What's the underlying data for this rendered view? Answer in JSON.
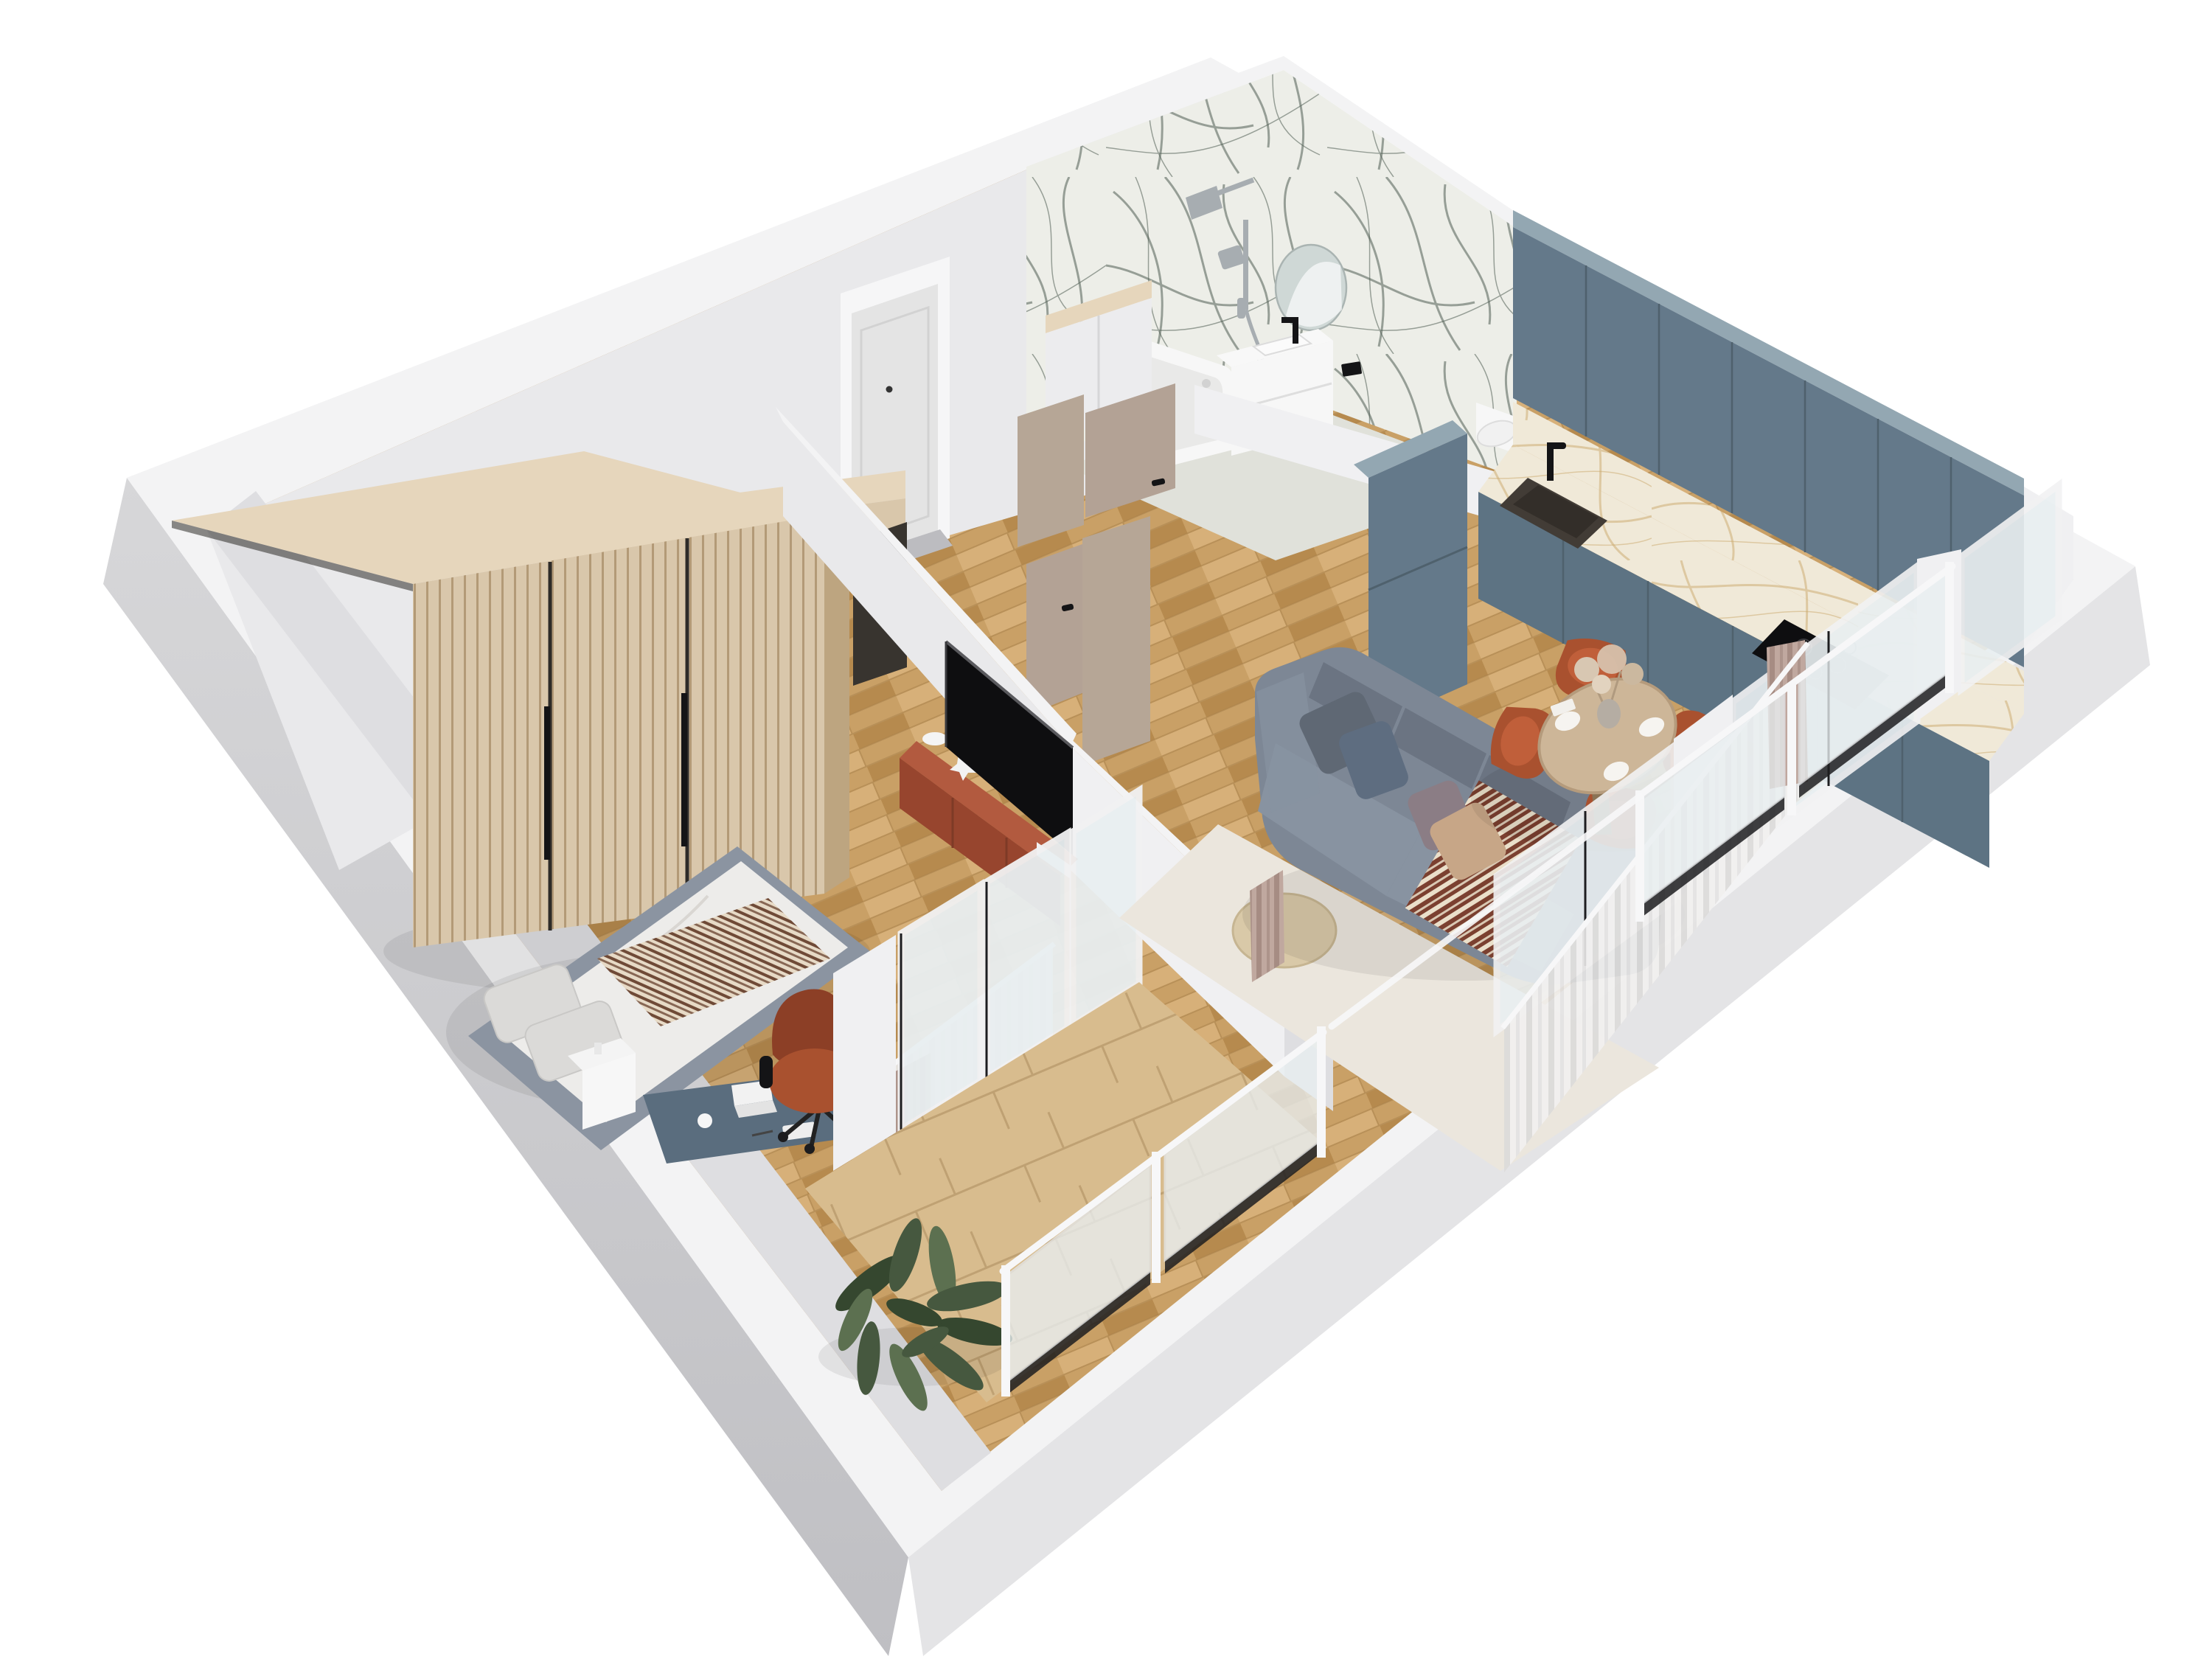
{
  "meta": {
    "title": "3D cutaway floor plan render of a one-bedroom apartment",
    "view": "isometric top-down architectural visualization",
    "visible_text": "none"
  },
  "palette": {
    "bg": "#ffffff",
    "band": "#f3f3f4",
    "outer1": "#d7d7d9",
    "outer2": "#bfbfc3",
    "outer3": "#e4e4e6",
    "innerWall": "#e9e9eb",
    "innerWall2": "#dedee1",
    "innerBright": "#f0f0f2",
    "beigeWall": "#b6a696",
    "doorTaupe": "#b3a295",
    "doorWhite": "#e4e4e4",
    "frameWhite": "#f6f6f7",
    "threshold": "#bcbcc0",
    "floorWood": "#c9a066",
    "floorWoodLight": "#d7b079",
    "floorWoodDark": "#b68a4e",
    "floorGap": "#a87f49",
    "tile": "#d8bc8e",
    "tileLine": "#bfa173",
    "bathFloor": "#e0e1da",
    "marbleBase": "#edeee8",
    "marbleVein": "#4e5c52",
    "marbleGold": "#f0e9d8",
    "marbleGoldVein": "#c9a76a",
    "cabBlue": "#64798a",
    "cabBlueDark": "#4f616d",
    "cabBlueTop": "#93a7b2",
    "cabBlueBase": "#5d7383",
    "sinkDark": "#423c36",
    "black": "#141416",
    "tvBlack": "#0e0e10",
    "chrome": "#a7adb1",
    "terracotta": "#b25a3f",
    "terracottaDark": "#97452e",
    "chairTerra": "#a9512f",
    "chairTerraDark": "#8c3f26",
    "chairTerraLight": "#c05f3a",
    "sofa": "#7d8795",
    "sofaDark": "#6b7482",
    "sofaLight": "#8893a1",
    "pillowDark": "#5f6874",
    "pillowBlue": "#5e6d80",
    "pillowBeige": "#c7a687",
    "pillowMauve": "#8b7d85",
    "throwBrown": "#7b4030",
    "throwCream": "#eadfca",
    "rug": "#ebe6dd",
    "pouf": "#d9c9a8",
    "wood": "#d9c7ab",
    "woodTop": "#e6d6bc",
    "woodDark": "#bda580",
    "slatLine": "#b39a77",
    "charcoal": "#38342f",
    "bedFrame": "#8b94a1",
    "duvet": "#edecea",
    "pillowWhite": "#dbdad8",
    "blanketCream": "#e7dac6",
    "blanketBrown": "#6f4a37",
    "deskBlue": "#5a6d7e",
    "tableWood": "#cdb698",
    "tableEdge": "#b59b7c",
    "tableLeg": "#8a7355",
    "glass": "#e9eff1",
    "glassDark": "#1d1d20",
    "railWhite": "#f7f7f8",
    "curtain": "#f1f0ef",
    "curtainShade": "#dcdbda",
    "curtainTaupe": "#c0a89f",
    "curtainTaupeDark": "#a68c83",
    "plant": "#46583f",
    "plantDark": "#35472f",
    "plantLight": "#5c7050",
    "mirror": "#cfd8d6",
    "white": "#f7f7f7",
    "pampas": "#d8c7b2",
    "vase": "#b5ada3"
  },
  "rooms": {
    "bedroom": {
      "label": "Bedroom",
      "items": [
        "slatted-wardrobe",
        "double-bed",
        "striped-throw",
        "nightstand",
        "desk",
        "terracotta-office-chair"
      ]
    },
    "hallway": {
      "label": "Hallway",
      "items": [
        "entry-door",
        "wood-console",
        "hall-closet",
        "bathroom-door",
        "living-room-door"
      ]
    },
    "bathroom": {
      "label": "Bathroom",
      "items": [
        "green-marble-walls",
        "bathtub",
        "shower-set",
        "vanity-with-sink",
        "round-mirror",
        "toilet",
        "flush-plate"
      ]
    },
    "kitchen": {
      "label": "Kitchen",
      "items": [
        "blue-upper-cabinets",
        "blue-base-cabinets",
        "tall-cabinet",
        "marble-counter",
        "sink",
        "black-faucet",
        "cooktop"
      ]
    },
    "living_dining": {
      "label": "Living + dining",
      "items": [
        "corner-sofa",
        "cushions",
        "patterned-throw",
        "cream-rug",
        "round-pouf",
        "round-dining-table",
        "terracotta-chairs",
        "table-setting",
        "dried-flower-vase",
        "sheer-curtains"
      ]
    },
    "media_wall": {
      "label": "Media wall",
      "items": [
        "tv",
        "terracotta-floating-console",
        "decor"
      ]
    },
    "balcony": {
      "label": "Balcony",
      "items": [
        "stone-tile-floor",
        "glass-railing",
        "french-windows",
        "fiddle-leaf-plant"
      ]
    }
  }
}
